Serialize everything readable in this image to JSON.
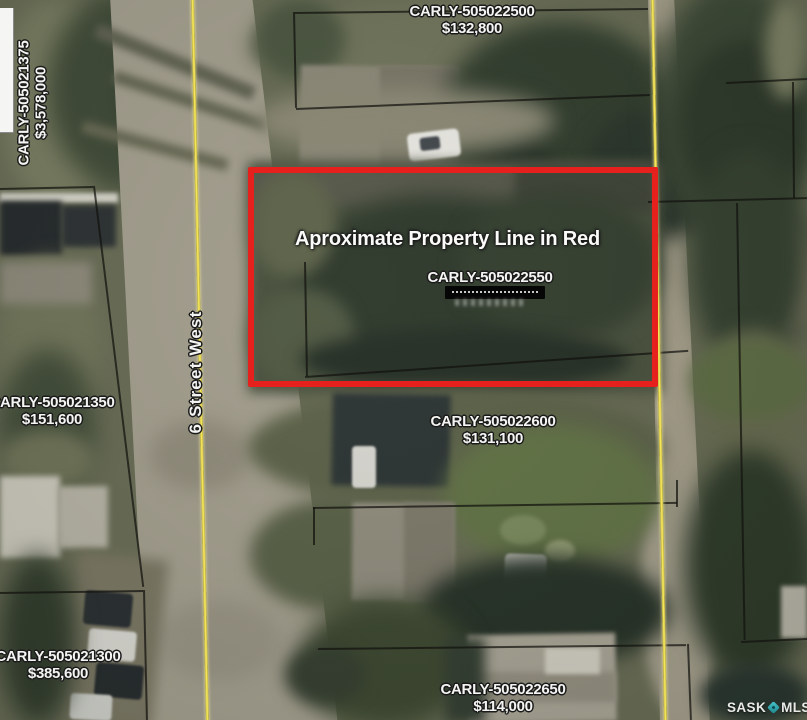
{
  "annotation": {
    "property_line_note": "Aproximate Property Line in Red"
  },
  "street": {
    "name": "6 Street West"
  },
  "parcels": {
    "p505022500": {
      "id": "CARLY-505022500",
      "price": "$132,800"
    },
    "p505021375": {
      "id": "CARLY-505021375",
      "price": "$3,578,000"
    },
    "p505022550": {
      "id": "CARLY-505022550",
      "price_redacted": true
    },
    "p505021350": {
      "id": "CARLY-505021350",
      "price": "$151,600"
    },
    "p505022600": {
      "id": "CARLY-505022600",
      "price": "$131,100"
    },
    "p505021300": {
      "id": "CARLY-505021300",
      "price": "$385,600"
    },
    "p505022650": {
      "id": "CARLY-505022650",
      "price": "$114,000"
    }
  },
  "branding": {
    "prefix": "SASK",
    "suffix": "MLS",
    "registered": "®"
  },
  "colors": {
    "property_outline_red": "#e5201d",
    "road_line_yellow": "#f0e050",
    "mls_diamond_teal": "#35b7bd"
  }
}
